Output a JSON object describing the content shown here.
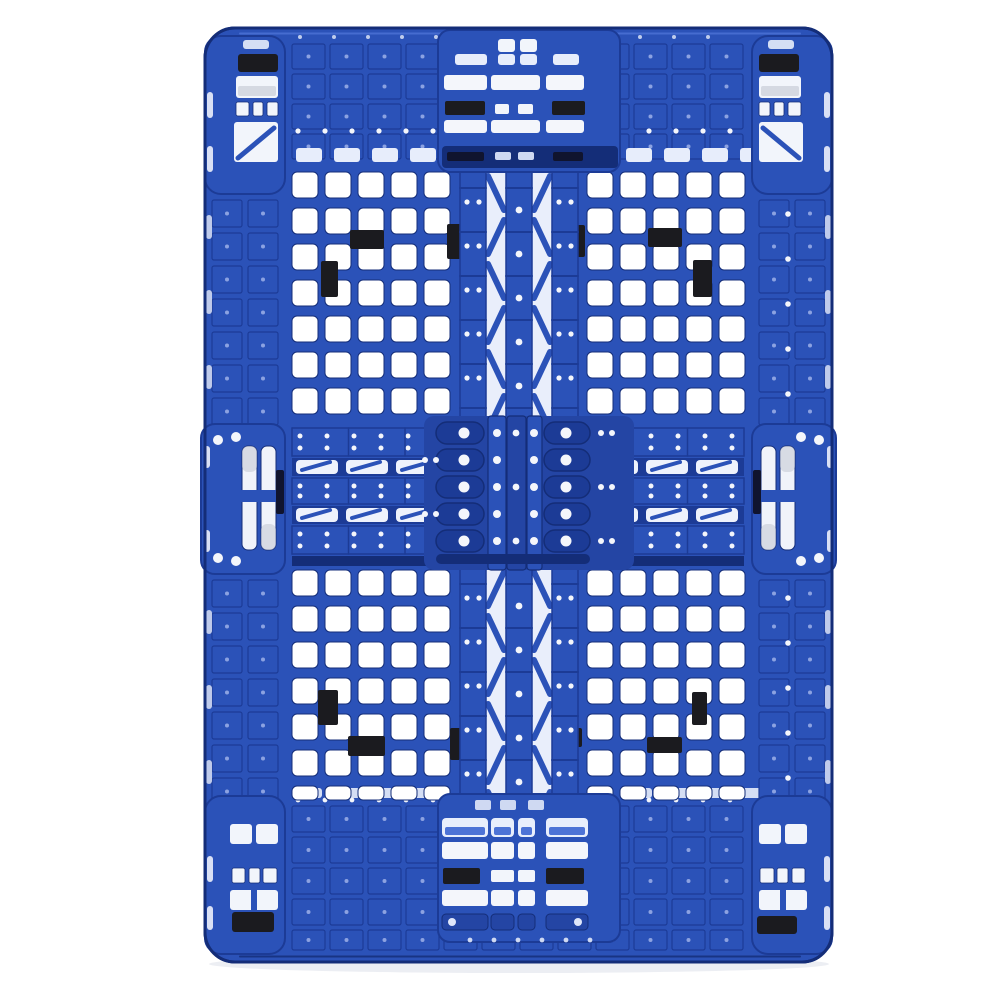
{
  "scene": {
    "type": "product-photograph",
    "subject": "heavy-duty blue injection-molded plastic shipping pallet",
    "view": "top-down",
    "orientation": "portrait",
    "background_color": "#ffffff",
    "text_content": "none"
  },
  "palette": {
    "blue_main": "#2b52b8",
    "blue_mid": "#2445a4",
    "blue_dark": "#1c3b96",
    "blue_deep": "#142d78",
    "blue_light": "#4d73d6",
    "blue_pale": "#9db0e8",
    "white_hole": "#f4f6fb",
    "pale_slot": "#e7edfb",
    "metal_gray": "#c2c7d2",
    "pad_black": "#1b1b1f",
    "deep_slot": "#10142e",
    "shadow": "#eceef3"
  },
  "structure": {
    "deck_quadrants": 4,
    "grid_cols_per_quadrant": 5,
    "feet": [
      "top-left",
      "top-center",
      "top-right",
      "middle-left",
      "center",
      "middle-right",
      "bottom-left",
      "bottom-center",
      "bottom-right"
    ],
    "black_plugs": {
      "top_left": [
        [
          350,
          230,
          34,
          19
        ],
        [
          321,
          261,
          17,
          36
        ],
        [
          447,
          224,
          17,
          35
        ]
      ],
      "top_right": [
        [
          567,
          225,
          18,
          32
        ],
        [
          648,
          228,
          34,
          19
        ],
        [
          693,
          260,
          19,
          37
        ]
      ],
      "bottom_left": [
        [
          318,
          690,
          20,
          35
        ],
        [
          348,
          736,
          37,
          20
        ],
        [
          450,
          728,
          17,
          32
        ]
      ],
      "bottom_right": [
        [
          563,
          728,
          19,
          19
        ],
        [
          692,
          692,
          15,
          33
        ],
        [
          647,
          737,
          35,
          16
        ]
      ]
    },
    "corner_pads": {
      "top_left": [
        238,
        54,
        40,
        18
      ],
      "top_right": [
        759,
        54,
        40,
        18
      ],
      "bottom_left": [
        232,
        912,
        42,
        20
      ],
      "bottom_right": [
        757,
        916,
        40,
        18
      ]
    },
    "top_center_pads": [
      [
        445,
        101,
        40,
        14
      ],
      [
        552,
        101,
        33,
        14
      ]
    ],
    "bottom_center_pads": [
      [
        443,
        868,
        37,
        16
      ],
      [
        546,
        868,
        38,
        16
      ]
    ],
    "edge_foot_dark_strips": [
      [
        276,
        470,
        8,
        44
      ],
      [
        753,
        470,
        8,
        44
      ]
    ]
  }
}
